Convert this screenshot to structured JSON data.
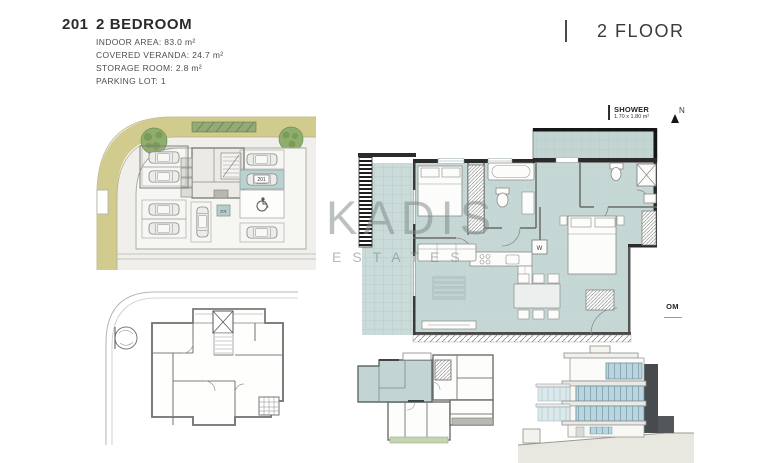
{
  "header": {
    "unit_number": "201",
    "unit_type": "2 BEDROOM",
    "specs": [
      "INDOOR AREA: 83.0 m²",
      "COVERED VERANDA: 24.7 m²",
      "STORAGE ROOM: 2.8 m²",
      "PARKING LOT: 1"
    ],
    "floor_label": "2 FLOOR"
  },
  "watermark": {
    "name": "KADIS",
    "subtitle": "ESTATES"
  },
  "main_plan": {
    "shower_label": "SHOWER",
    "shower_size": "1.70 x 1.80 m²",
    "north": "N",
    "washer": "W",
    "cropped_room_label": "OM"
  },
  "site_plan": {
    "parking_label": "201",
    "storage_label": "201"
  },
  "colors": {
    "plan_fill": "#c6d8d6",
    "veranda_fill": "#cadbd9",
    "terrace_fill": "#c3d5d3",
    "road": "#d2cb8e",
    "site_background": "#f0efeb",
    "tree_green": "#8fae6e",
    "highlight_teal": "#bad1cf",
    "green_strip": "#c6d4b2",
    "elevation_glass": "#b9d6e0",
    "dark_panel": "#474b4e",
    "wall_dark": "#2b2b2b",
    "watermark_gray": "#7c8888"
  }
}
